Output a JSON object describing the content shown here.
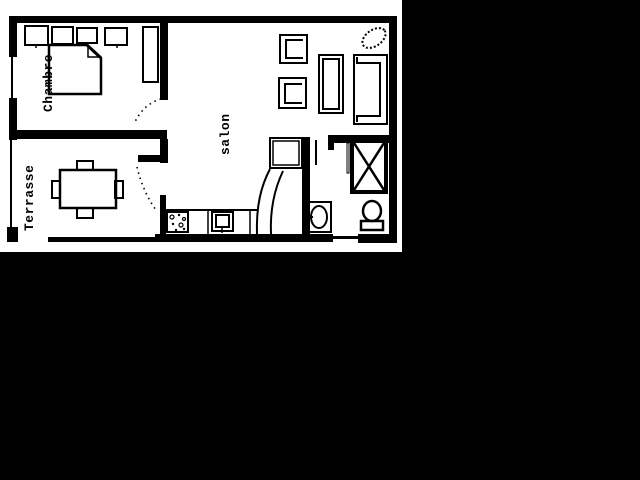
{
  "meta": {
    "type": "apartment-floor-plan",
    "colors": {
      "screen_background": "#000000",
      "paper": "#ffffff",
      "ink": "#000000"
    }
  },
  "rooms": {
    "bedroom": {
      "label": "Chambre"
    },
    "terrace": {
      "label": "Terrasse"
    },
    "living": {
      "label": "salon"
    }
  }
}
